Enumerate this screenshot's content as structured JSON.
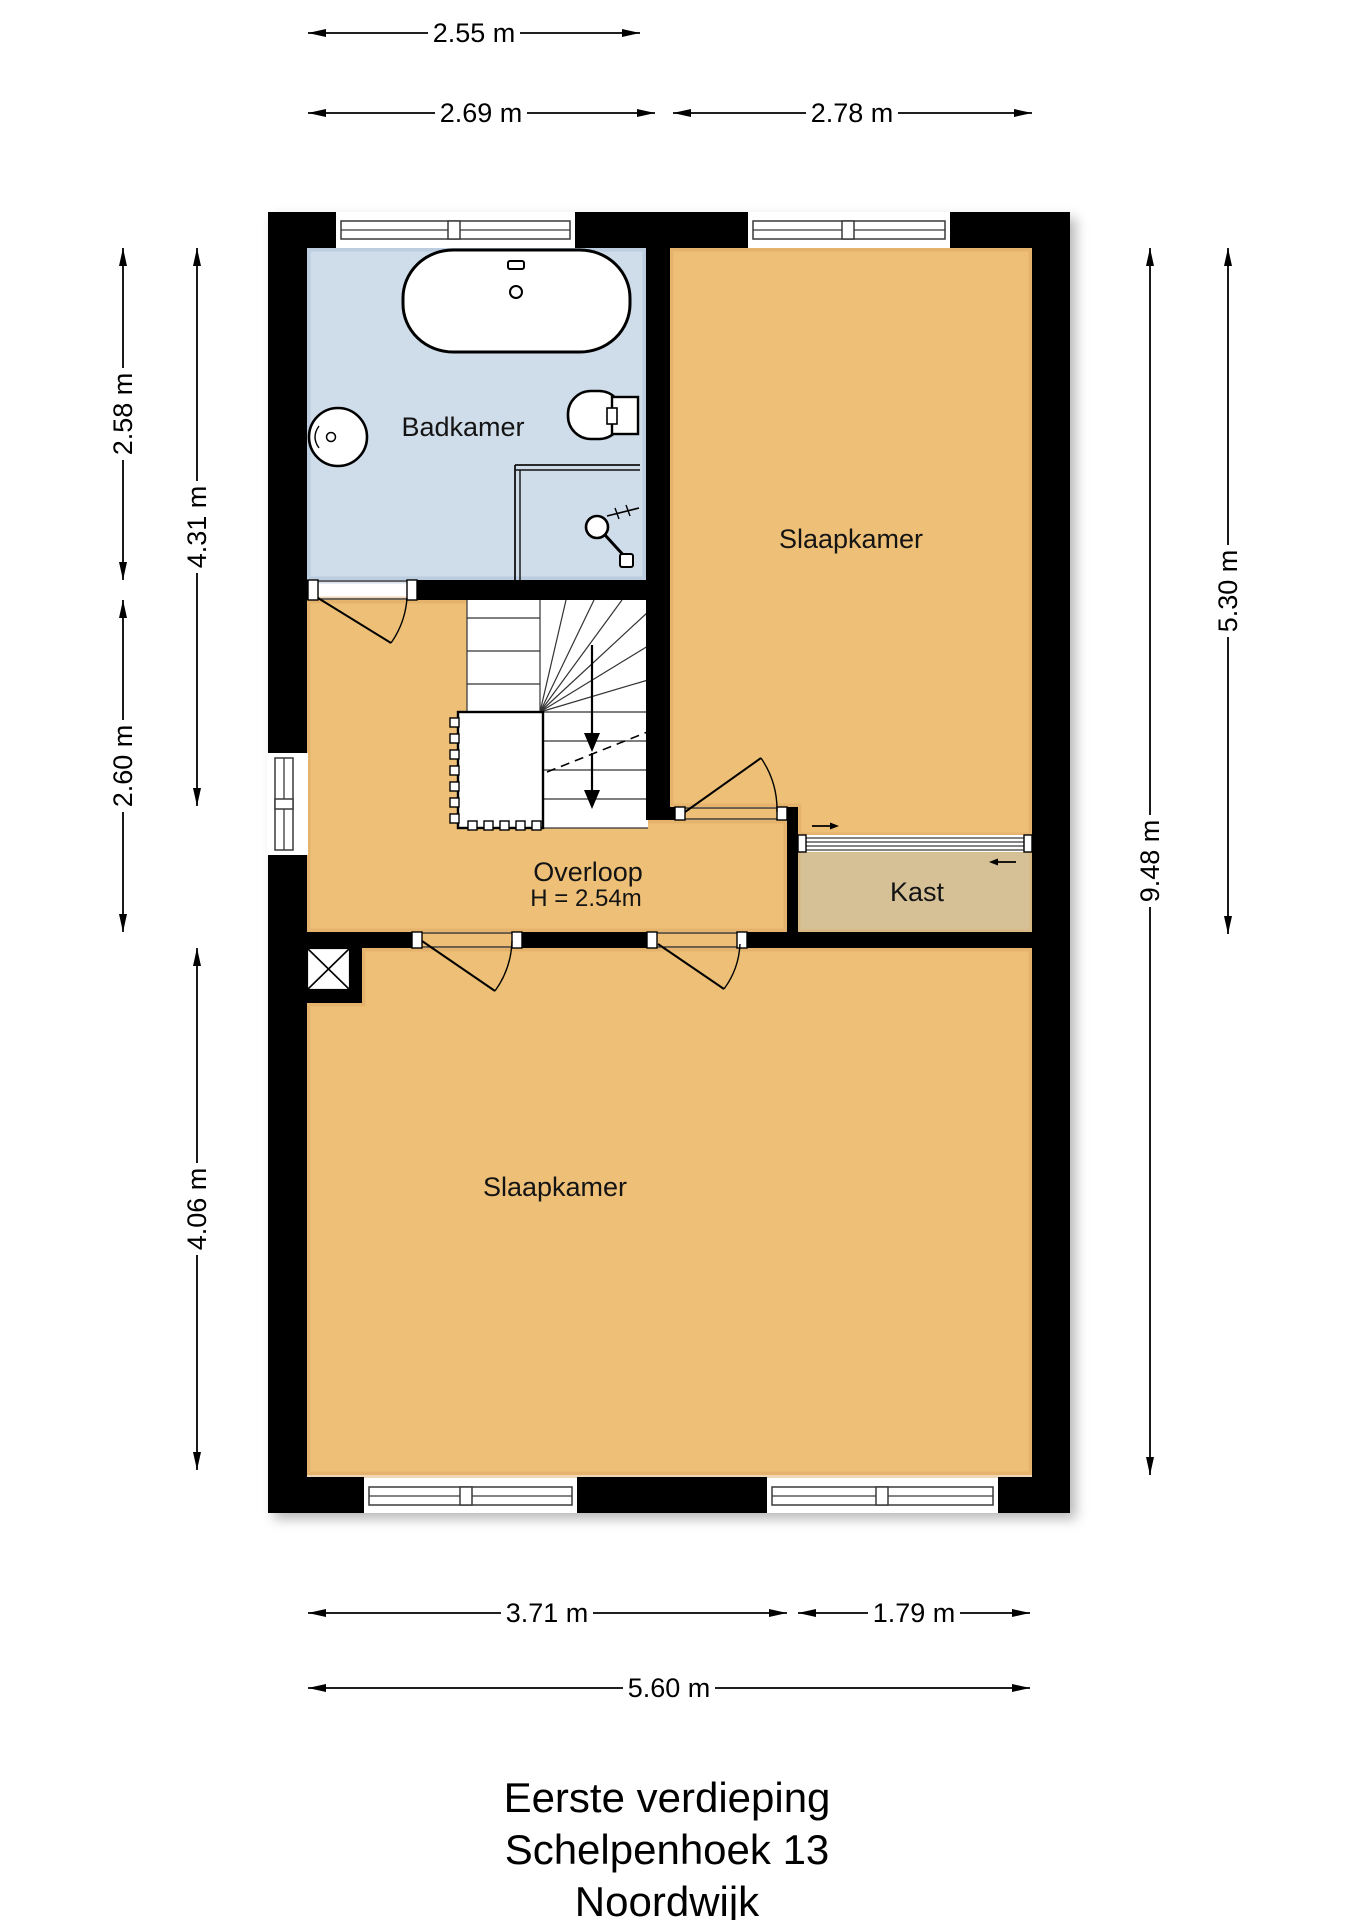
{
  "title": {
    "line1": "Eerste verdieping",
    "line2": "Schelpenhoek 13",
    "line3": "Noordwijk"
  },
  "rooms": {
    "badkamer": {
      "label": "Badkamer"
    },
    "slaapkamer_top": {
      "label": "Slaapkamer"
    },
    "overloop": {
      "label": "Overloop",
      "height_note": "H = 2.54m"
    },
    "kast": {
      "label": "Kast"
    },
    "slaapkamer_bottom": {
      "label": "Slaapkamer"
    }
  },
  "dimensions": {
    "top": [
      {
        "label": "2.55 m"
      },
      {
        "label": "2.69 m"
      },
      {
        "label": "2.78 m"
      }
    ],
    "left": [
      {
        "label": "2.58 m"
      },
      {
        "label": "2.60 m"
      },
      {
        "label": "4.31 m"
      },
      {
        "label": "4.06 m"
      }
    ],
    "right": [
      {
        "label": "5.30 m"
      },
      {
        "label": "9.48 m"
      }
    ],
    "bottom": [
      {
        "label": "3.71 m"
      },
      {
        "label": "1.79 m"
      },
      {
        "label": "5.60 m"
      }
    ]
  },
  "colors": {
    "floor_orange": "#eec077",
    "floor_orange_edge": "#d9a55f",
    "floor_blue": "#cfdcea",
    "floor_blue_edge": "#a8bdd2",
    "floor_kast": "#d6c096",
    "wall": "#000000"
  }
}
